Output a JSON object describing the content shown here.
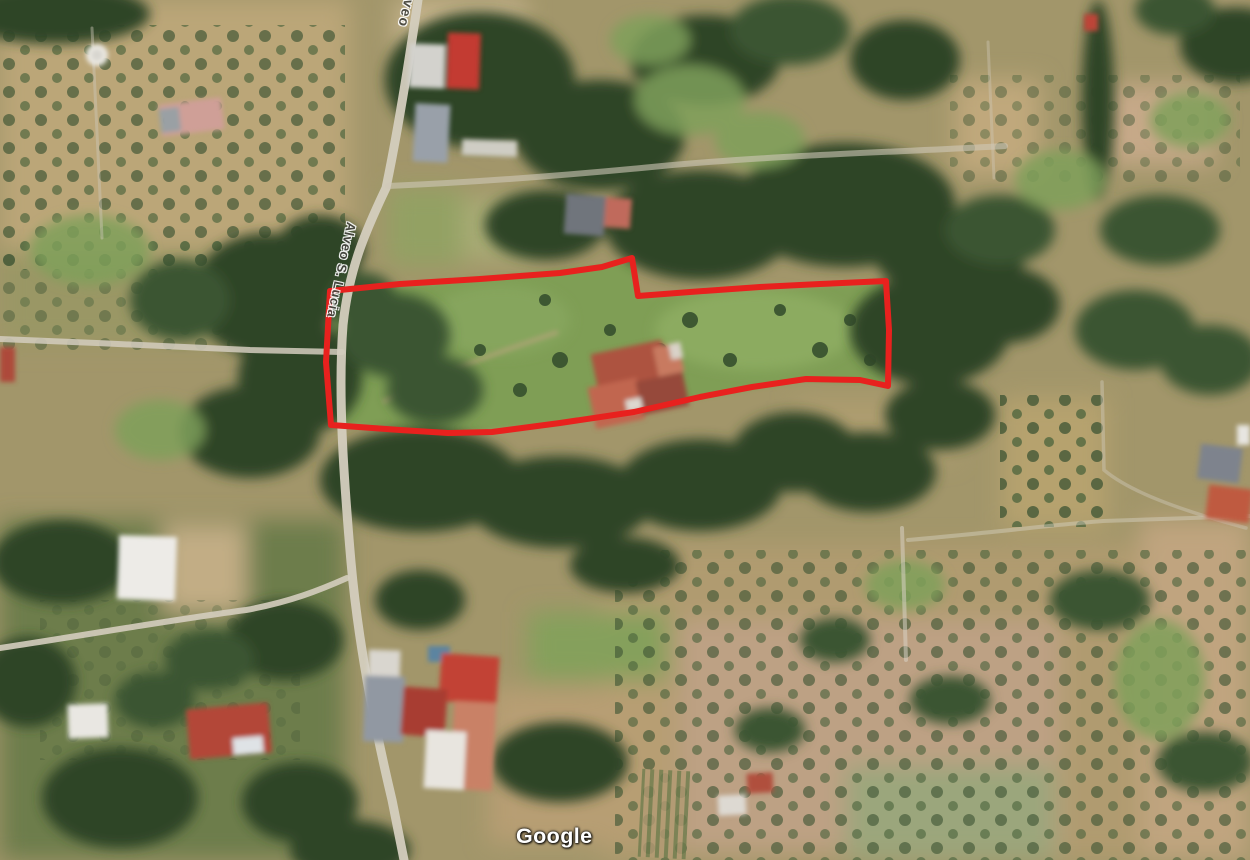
{
  "map": {
    "type": "satellite-imagery",
    "road_labels": {
      "top": "Alveo",
      "main": "Alveo S. Lucia"
    },
    "watermark": "Google",
    "overlay": {
      "label": "parcel-boundary",
      "color": "#e8211e",
      "stroke_width": 6,
      "points": [
        [
          330,
          291
        ],
        [
          400,
          284
        ],
        [
          480,
          279
        ],
        [
          560,
          273
        ],
        [
          602,
          267
        ],
        [
          632,
          258
        ],
        [
          638,
          296
        ],
        [
          690,
          292
        ],
        [
          760,
          287
        ],
        [
          820,
          284
        ],
        [
          886,
          281
        ],
        [
          889,
          330
        ],
        [
          888,
          386
        ],
        [
          860,
          380
        ],
        [
          806,
          379
        ],
        [
          752,
          387
        ],
        [
          700,
          397
        ],
        [
          634,
          412
        ],
        [
          560,
          423
        ],
        [
          492,
          432
        ],
        [
          448,
          433
        ],
        [
          400,
          430
        ],
        [
          331,
          425
        ],
        [
          326,
          362
        ]
      ]
    },
    "colors": {
      "road_label_text": "#45453e",
      "watermark_text": "#ffffff",
      "boundary_red": "#e8211e"
    }
  }
}
